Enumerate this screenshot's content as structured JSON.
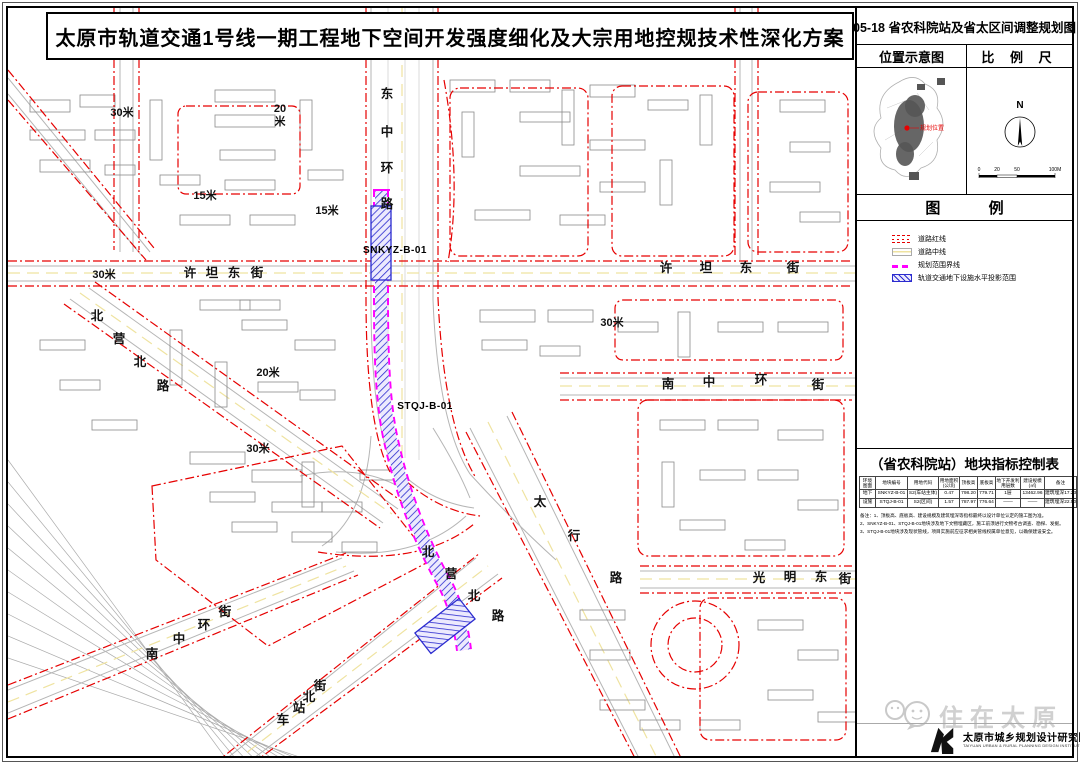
{
  "title": "太原市轨道交通1号线一期工程地下空间开发强度细化及大宗用地控规技术性深化方案",
  "panel": {
    "sheet_title": "05-18 省农科院站及省太区间调整规划图",
    "location_label": "位置示意图",
    "scale_label": "比 例 尺",
    "compass_n": "N",
    "location_marker_label": "规划位置",
    "scale": {
      "t0": "0",
      "t1": "20",
      "t2": "50",
      "t3": "100M"
    },
    "legend": {
      "title": "图 例",
      "items": [
        {
          "type": "redline",
          "label": "道路红线"
        },
        {
          "type": "centerline",
          "label": "道路中线"
        },
        {
          "type": "boundary",
          "label": "规划范围界线"
        },
        {
          "type": "metro",
          "label": "轨道交通地下设施水平投影范围"
        }
      ]
    },
    "table": {
      "title": "（省农科院站）地块指标控制表",
      "headers": [
        "环境\n图面",
        "地块编号",
        "用地代码",
        "用地面积\n(公顷)",
        "顶板高",
        "底板高",
        "地下开发利\n用层数",
        "建设规模\n(㎡)",
        "备注"
      ],
      "rows": [
        [
          "地下",
          "SNKYZ-B-01",
          "S2(车站主体)",
          "0.47",
          "798.20",
          "779.71",
          "1层",
          "13462.96",
          "建筑埋深17.23米"
        ],
        [
          "设施",
          "STQJ-B-01",
          "S2(区间)",
          "1.57",
          "787.97",
          "776.64",
          "——",
          "——",
          "建筑埋深22.50米"
        ]
      ],
      "notes": [
        "备注：1、顶板高、底板高、建设规模及建筑埋深等指标最终以设计单位认定的施工图为准。",
        "2、SNKYZ-B-01、STQJ-B-01地块涉及地下文物埋藏区，施工前须进行文物考古调查、勘探、发掘。",
        "3、STQJ-B-01地块涉及现状管线，项目实施前应征求相关管线权属单位意见，以确保建设安全。"
      ]
    },
    "watermark": "住在太原",
    "institute_cn": "太原市城乡规划设计研究院",
    "institute_en": "TAIYUAN URBAN & RURAL PLANNING DESIGN INSTITUTE"
  },
  "map": {
    "street_labels": [
      "东中环路",
      "许坦东街",
      "许坦东街",
      "北营北路",
      "南中环街",
      "太行路",
      "北营北路",
      "光明东街",
      "南中环街",
      "车站北街"
    ],
    "road_width_labels": [
      "30米",
      "20米",
      "15米",
      "15米",
      "30米",
      "20米",
      "30米",
      "30米"
    ],
    "parcel_codes": [
      "SNKYZ-B-01",
      "STQJ-B-01"
    ],
    "colors": {
      "road_redline": "#e60000",
      "boundary_magenta": "#ff00ff",
      "metro_blue": "#2b2bcf",
      "metro_hatch_fill": "#eceafd"
    }
  }
}
